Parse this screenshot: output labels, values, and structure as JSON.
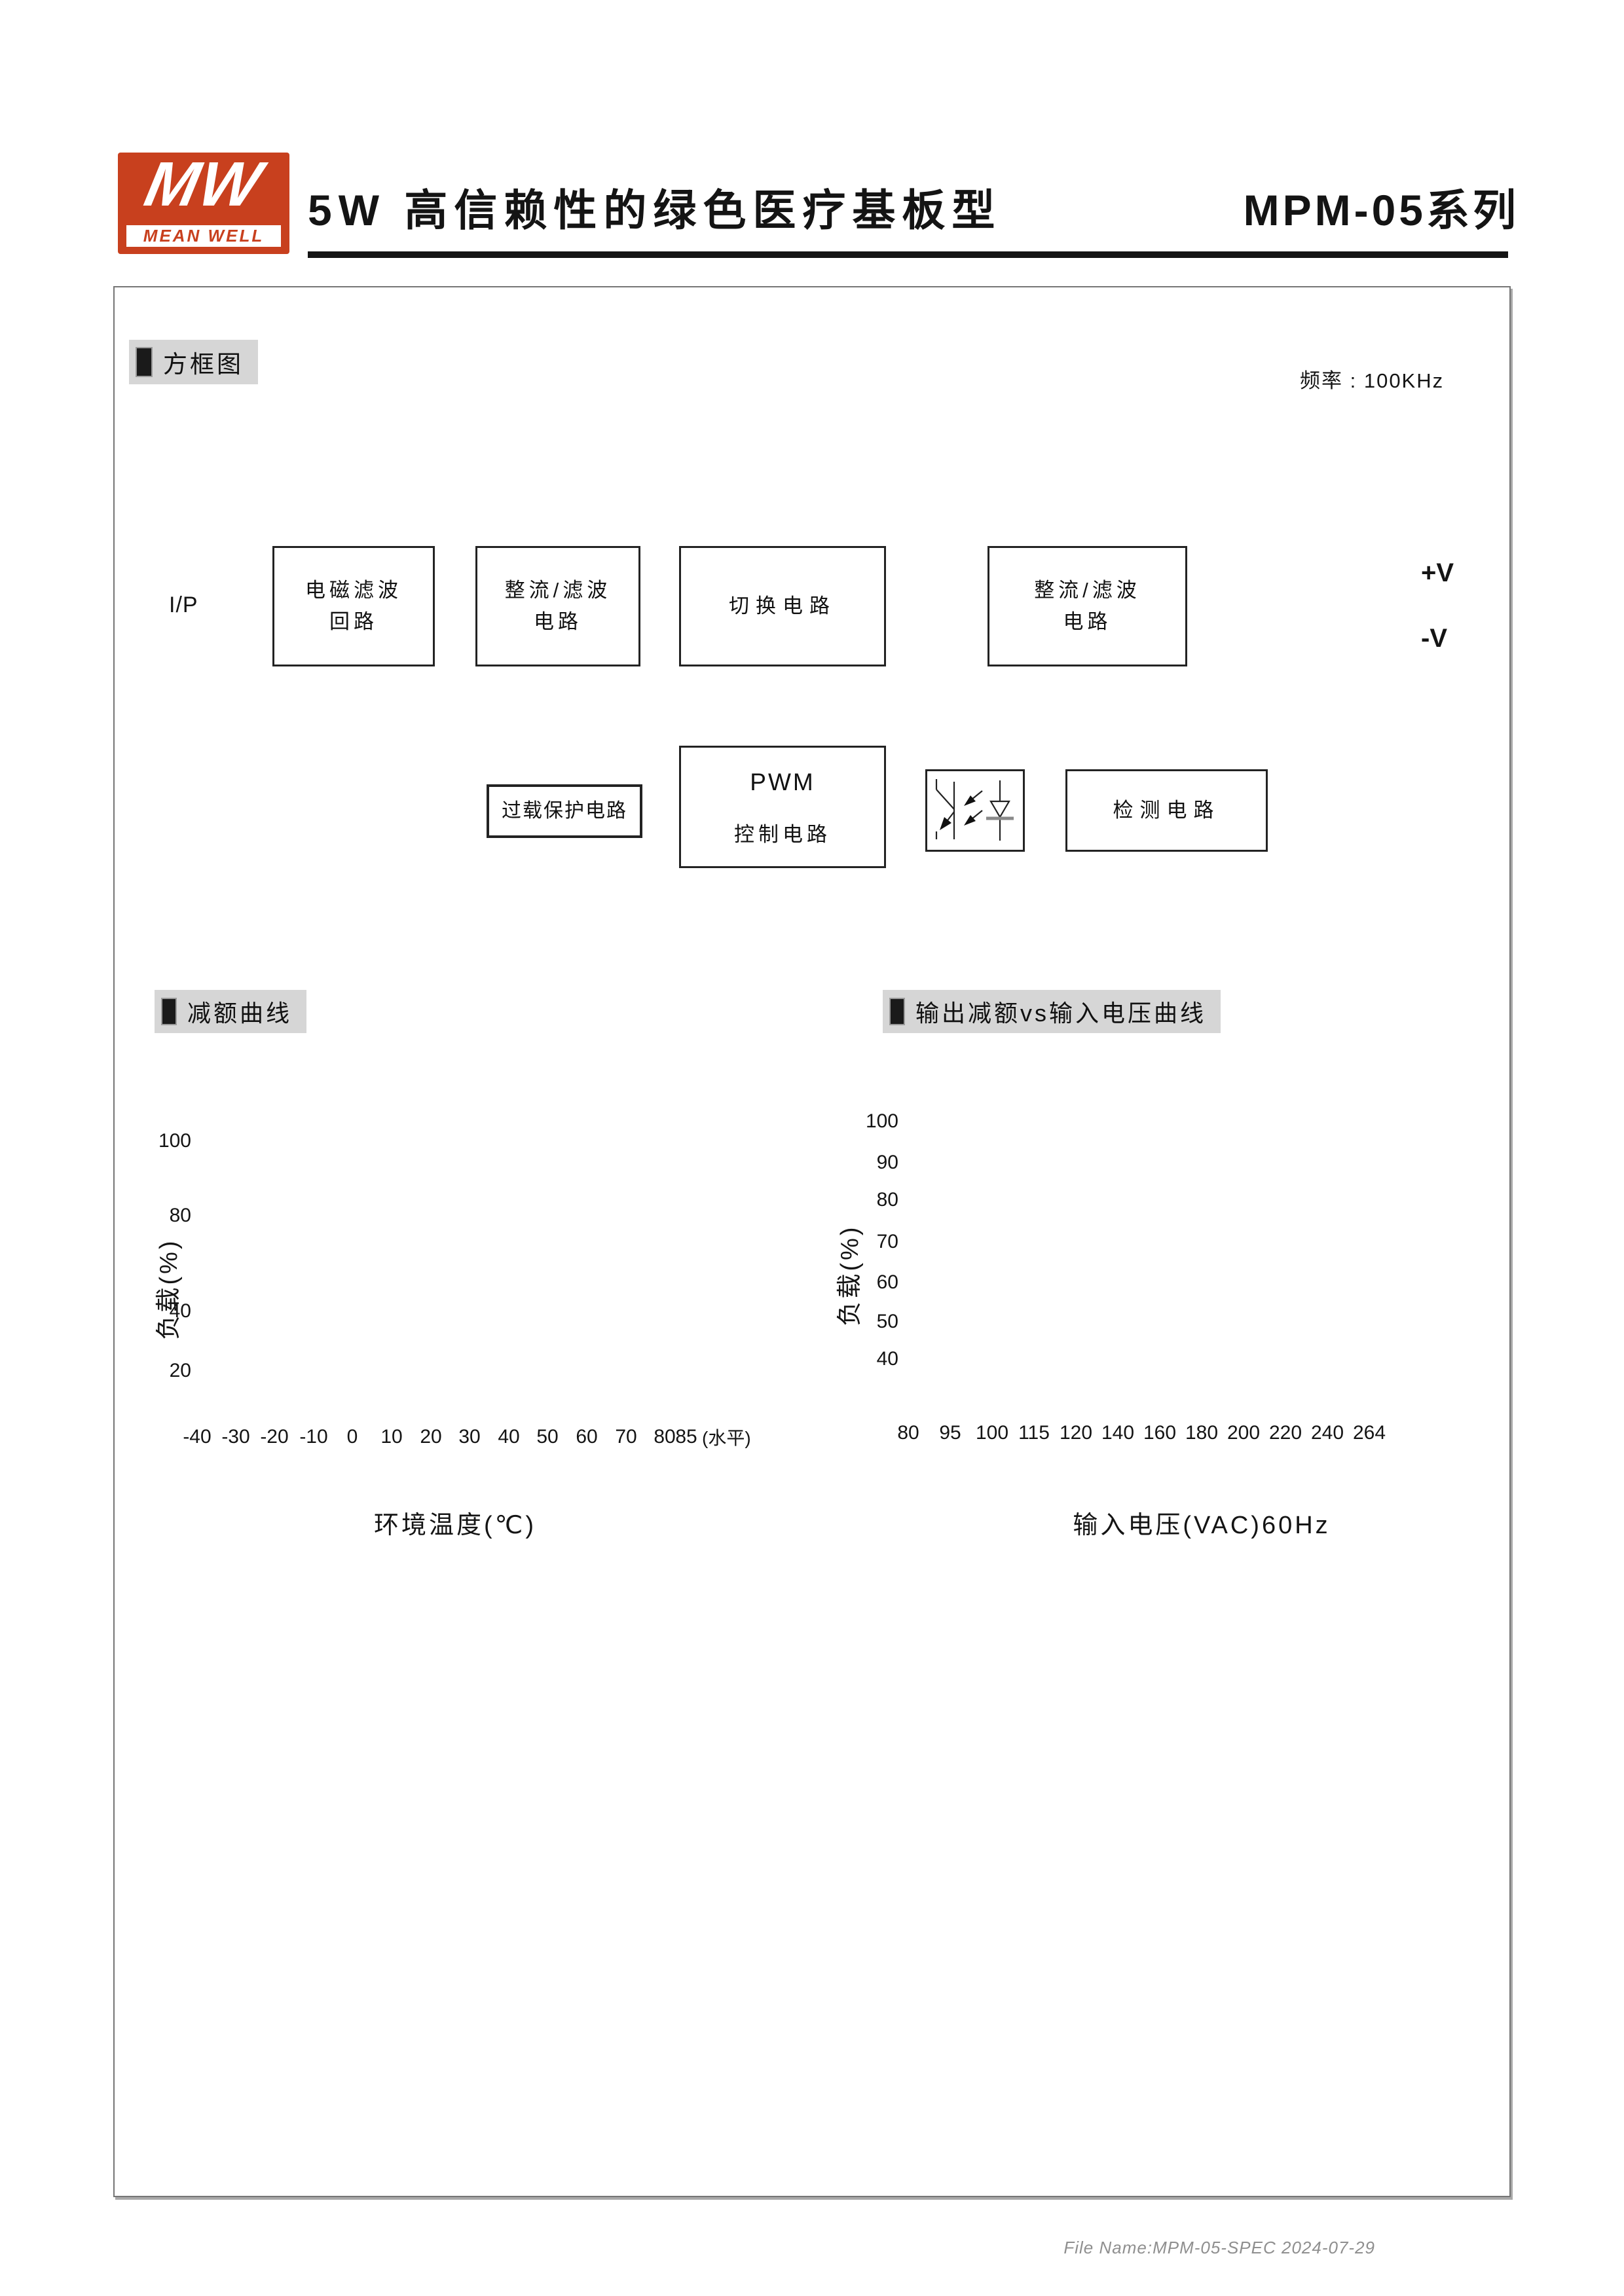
{
  "colors": {
    "logo_red": "#c8401e",
    "section_bg": "#d6d6d6",
    "line_black": "#1a1a1a",
    "connector_gray": "#8f8f8f"
  },
  "header": {
    "logo_mw": "MW",
    "logo_name": "MEAN WELL",
    "title": "5W 高信赖性的绿色医疗基板型",
    "series": "MPM-05系列"
  },
  "frequency_note": "频率 : 100KHz",
  "sections": {
    "block_diagram": "方框图",
    "derating": "减额曲线",
    "output_derating": "输出减额vs输入电压曲线"
  },
  "block_diagram": {
    "input_label": "I/P",
    "emi_box": "电磁滤波\n回路",
    "rectifier_box": "整流/滤波\n电路",
    "switching_box": "切换电路",
    "output_rectifier_box": "整流/滤波\n电路",
    "overload_box": "过载保护电路",
    "pwm_title": "PWM",
    "pwm_sub": "控制电路",
    "detection_box": "检测电路",
    "output_pos": "+V",
    "output_neg": "-V"
  },
  "charts": {
    "derating": {
      "y_axis_title": "负载(%)",
      "x_caption": "环境温度(℃)",
      "y_ticks": [
        "100",
        "80",
        "40",
        "20"
      ],
      "x_ticks": [
        "-40",
        "-30",
        "-20",
        "-10",
        "0",
        "10",
        "20",
        "30",
        "40",
        "50",
        "60",
        "70",
        "80",
        "85"
      ],
      "x_suffix": "(水平)"
    },
    "output_derating": {
      "y_axis_title": "负载(%)",
      "x_caption": "输入电压(VAC)60Hz",
      "y_ticks": [
        "100",
        "90",
        "80",
        "70",
        "60",
        "50",
        "40"
      ],
      "x_ticks": [
        "80",
        "95",
        "100",
        "115",
        "120",
        "140",
        "160",
        "180",
        "200",
        "220",
        "240",
        "264"
      ]
    }
  },
  "chart_data": [
    {
      "type": "line",
      "title": "减额曲线",
      "xlabel": "环境温度(℃)",
      "ylabel": "负载(%)",
      "x": [
        -40,
        60,
        70,
        80,
        85,
        85
      ],
      "y": [
        100,
        100,
        80,
        40,
        20,
        0
      ],
      "x_ticks": [
        -40,
        -30,
        -20,
        -10,
        0,
        10,
        20,
        30,
        40,
        50,
        60,
        70,
        80,
        85
      ],
      "y_ticks": [
        100,
        80,
        40,
        20
      ],
      "x_suffix_note": "(水平)",
      "guides": "dashed verticals at x=60,70,80; dashed horizontals at y=80,40,20",
      "legend": "none",
      "grid": "off"
    },
    {
      "type": "line",
      "title": "输出减额vs输入电压曲线",
      "xlabel": "输入电压(VAC)60Hz",
      "ylabel": "负载(%)",
      "x": [
        80,
        100,
        264
      ],
      "y": [
        80,
        100,
        100
      ],
      "x_ticks": [
        80,
        95,
        100,
        115,
        120,
        140,
        160,
        180,
        200,
        220,
        240,
        264
      ],
      "y_ticks": [
        100,
        90,
        80,
        70,
        60,
        50,
        40
      ],
      "guides": "dashed vertical at x=100",
      "legend": "none",
      "grid": "off"
    }
  ],
  "footer": "File Name:MPM-05-SPEC  2024-07-29"
}
